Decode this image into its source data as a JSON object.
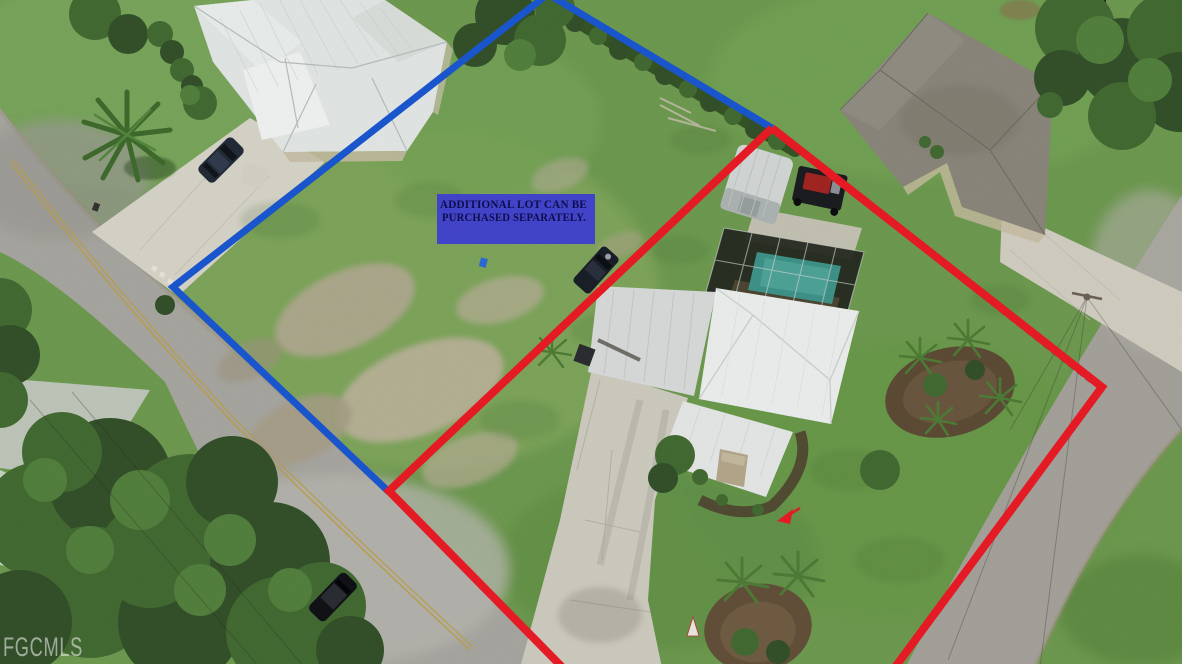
{
  "overlays": {
    "callout": {
      "line1": "ADDITIONAL LOT CAN BE",
      "line2": "PURCHASED SEPARATELY.",
      "box_color": "#4345cd",
      "text_color": "#0e0e4e"
    },
    "watermark": {
      "text": "FGCMLS",
      "color": "#e9ebe6"
    },
    "blue_outline": {
      "color": "#1a57d1"
    },
    "red_outline": {
      "color": "#ea1b25"
    }
  }
}
